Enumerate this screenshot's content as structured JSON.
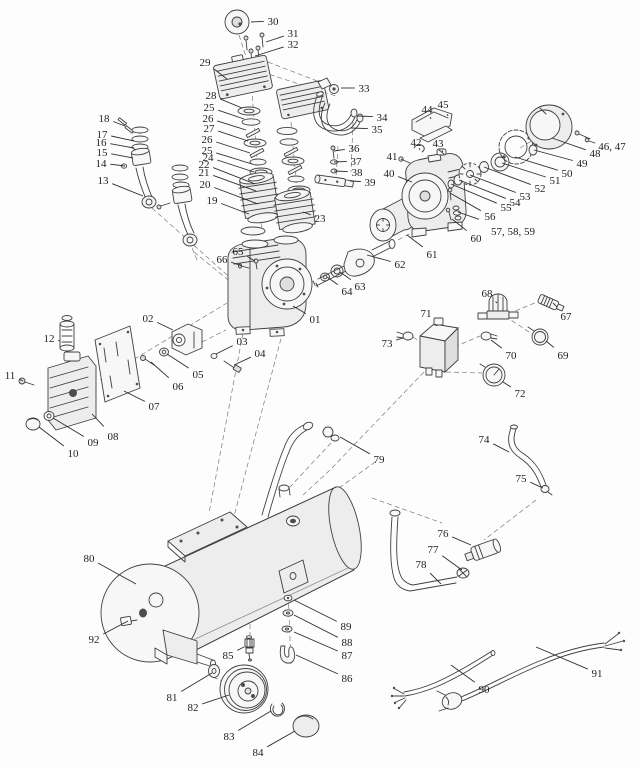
{
  "diagram": {
    "type": "exploded-parts-diagram",
    "subject": "air-compressor",
    "canvas": {
      "width": 640,
      "height": 768
    },
    "colors": {
      "background": "#fdfdfd",
      "line": "#3f3f3f",
      "label": "#1f1f1f",
      "dashed": "#7a7a7a"
    },
    "parts": [
      {
        "n": "30",
        "lx": 273,
        "ly": 21,
        "tx": 251,
        "ty": 22
      },
      {
        "n": "31",
        "lx": 293,
        "ly": 33,
        "tx": 266,
        "ty": 42
      },
      {
        "n": "32",
        "lx": 293,
        "ly": 44,
        "tx": 255,
        "ty": 56
      },
      {
        "n": "29",
        "lx": 205,
        "ly": 62,
        "tx": 227,
        "ty": 79
      },
      {
        "n": "33",
        "lx": 364,
        "ly": 88,
        "tx": 341,
        "ty": 88
      },
      {
        "n": "34",
        "lx": 382,
        "ly": 117,
        "tx": 357,
        "ty": 116
      },
      {
        "n": "35",
        "lx": 377,
        "ly": 129,
        "tx": 351,
        "ty": 128
      },
      {
        "n": "28",
        "lx": 211,
        "ly": 95,
        "tx": 242,
        "ty": 108
      },
      {
        "n": "25",
        "lx": 209,
        "ly": 107,
        "tx": 244,
        "ty": 119
      },
      {
        "n": "26",
        "lx": 208,
        "ly": 118,
        "tx": 246,
        "ty": 130
      },
      {
        "n": "27",
        "lx": 209,
        "ly": 128,
        "tx": 248,
        "ty": 141
      },
      {
        "n": "26",
        "lx": 207,
        "ly": 139,
        "tx": 250,
        "ty": 153
      },
      {
        "n": "25",
        "lx": 207,
        "ly": 150,
        "tx": 252,
        "ty": 164
      },
      {
        "n": "24",
        "lx": 208,
        "ly": 157,
        "tx": 254,
        "ty": 172
      },
      {
        "n": "22",
        "lx": 204,
        "ly": 164,
        "tx": 255,
        "ty": 184
      },
      {
        "n": "21",
        "lx": 204,
        "ly": 172,
        "tx": 256,
        "ty": 191
      },
      {
        "n": "20",
        "lx": 205,
        "ly": 184,
        "tx": 258,
        "ty": 204
      },
      {
        "n": "19",
        "lx": 212,
        "ly": 200,
        "tx": 249,
        "ty": 214
      },
      {
        "n": "18",
        "lx": 104,
        "ly": 118,
        "tx": 125,
        "ty": 126
      },
      {
        "n": "17",
        "lx": 102,
        "ly": 134,
        "tx": 134,
        "ty": 141
      },
      {
        "n": "16",
        "lx": 101,
        "ly": 142,
        "tx": 134,
        "ty": 148
      },
      {
        "n": "15",
        "lx": 102,
        "ly": 152,
        "tx": 133,
        "ty": 158
      },
      {
        "n": "14",
        "lx": 101,
        "ly": 163,
        "tx": 125,
        "ty": 166
      },
      {
        "n": "13",
        "lx": 103,
        "ly": 180,
        "tx": 143,
        "ty": 196
      },
      {
        "n": "23",
        "lx": 320,
        "ly": 218,
        "tx": 303,
        "ty": 212
      },
      {
        "n": "36",
        "lx": 354,
        "ly": 148,
        "tx": 334,
        "ty": 151
      },
      {
        "n": "37",
        "lx": 356,
        "ly": 161,
        "tx": 334,
        "ty": 162
      },
      {
        "n": "38",
        "lx": 357,
        "ly": 172,
        "tx": 334,
        "ty": 171
      },
      {
        "n": "39",
        "lx": 370,
        "ly": 182,
        "tx": 350,
        "ty": 181
      },
      {
        "n": "41",
        "lx": 392,
        "ly": 156,
        "tx": 403,
        "ty": 160
      },
      {
        "n": "40",
        "lx": 389,
        "ly": 173,
        "tx": 412,
        "ty": 182
      },
      {
        "n": "42",
        "lx": 416,
        "ly": 142,
        "tx": 420,
        "ty": 150
      },
      {
        "n": "43",
        "lx": 438,
        "ly": 143,
        "tx": 443,
        "ty": 152
      },
      {
        "n": "44",
        "lx": 427,
        "ly": 109,
        "tx": 431,
        "ty": 119
      },
      {
        "n": "45",
        "lx": 443,
        "ly": 104,
        "tx": 448,
        "ty": 116
      },
      {
        "n": "46, 47",
        "lx": 612,
        "ly": 146,
        "tx": 585,
        "ty": 137
      },
      {
        "n": "48",
        "lx": 595,
        "ly": 153,
        "tx": 552,
        "ty": 138
      },
      {
        "n": "49",
        "lx": 582,
        "ly": 163,
        "tx": 534,
        "ty": 150
      },
      {
        "n": "50",
        "lx": 567,
        "ly": 173,
        "tx": 515,
        "ty": 157
      },
      {
        "n": "51",
        "lx": 555,
        "ly": 180,
        "tx": 502,
        "ty": 163
      },
      {
        "n": "52",
        "lx": 540,
        "ly": 188,
        "tx": 484,
        "ty": 167
      },
      {
        "n": "53",
        "lx": 525,
        "ly": 196,
        "tx": 470,
        "ty": 175
      },
      {
        "n": "54",
        "lx": 515,
        "ly": 202,
        "tx": 459,
        "ty": 180
      },
      {
        "n": "55",
        "lx": 506,
        "ly": 207,
        "tx": 451,
        "ty": 184
      },
      {
        "n": "56",
        "lx": 490,
        "ly": 216,
        "tx": 450,
        "ty": 193
      },
      {
        "n": "57, 58, 59",
        "lx": 513,
        "ly": 231,
        "tx": 458,
        "ty": 212
      },
      {
        "n": "60",
        "lx": 476,
        "ly": 238,
        "tx": 452,
        "ty": 219
      },
      {
        "n": "61",
        "lx": 432,
        "ly": 254,
        "tx": 407,
        "ty": 235
      },
      {
        "n": "62",
        "lx": 400,
        "ly": 264,
        "tx": 367,
        "ty": 255
      },
      {
        "n": "63",
        "lx": 360,
        "ly": 286,
        "tx": 340,
        "ty": 272
      },
      {
        "n": "64",
        "lx": 347,
        "ly": 291,
        "tx": 327,
        "ty": 277
      },
      {
        "n": "65",
        "lx": 238,
        "ly": 251,
        "tx": 255,
        "ty": 261
      },
      {
        "n": "66",
        "lx": 222,
        "ly": 259,
        "tx": 242,
        "ty": 266
      },
      {
        "n": "01",
        "lx": 315,
        "ly": 319,
        "tx": 293,
        "ty": 306
      },
      {
        "n": "02",
        "lx": 148,
        "ly": 318,
        "tx": 173,
        "ty": 330
      },
      {
        "n": "03",
        "lx": 242,
        "ly": 341,
        "tx": 216,
        "ty": 354
      },
      {
        "n": "04",
        "lx": 260,
        "ly": 353,
        "tx": 234,
        "ty": 365
      },
      {
        "n": "05",
        "lx": 198,
        "ly": 374,
        "tx": 167,
        "ty": 354
      },
      {
        "n": "06",
        "lx": 178,
        "ly": 386,
        "tx": 151,
        "ty": 362
      },
      {
        "n": "07",
        "lx": 154,
        "ly": 406,
        "tx": 124,
        "ty": 391
      },
      {
        "n": "08",
        "lx": 113,
        "ly": 436,
        "tx": 92,
        "ty": 414
      },
      {
        "n": "09",
        "lx": 93,
        "ly": 442,
        "tx": 53,
        "ty": 418
      },
      {
        "n": "10",
        "lx": 73,
        "ly": 453,
        "tx": 39,
        "ty": 427
      },
      {
        "n": "11",
        "lx": 10,
        "ly": 375,
        "tx": 23,
        "ty": 381
      },
      {
        "n": "12",
        "lx": 49,
        "ly": 338,
        "tx": 60,
        "ty": 341
      },
      {
        "n": "67",
        "lx": 566,
        "ly": 316,
        "tx": 553,
        "ty": 303
      },
      {
        "n": "68",
        "lx": 487,
        "ly": 293,
        "tx": 497,
        "ty": 303
      },
      {
        "n": "69",
        "lx": 563,
        "ly": 355,
        "tx": 546,
        "ty": 341
      },
      {
        "n": "70",
        "lx": 511,
        "ly": 355,
        "tx": 491,
        "ty": 340
      },
      {
        "n": "71",
        "lx": 426,
        "ly": 313,
        "tx": 437,
        "ty": 326
      },
      {
        "n": "72",
        "lx": 520,
        "ly": 393,
        "tx": 503,
        "ty": 382
      },
      {
        "n": "73",
        "lx": 387,
        "ly": 343,
        "tx": 403,
        "ty": 338
      },
      {
        "n": "74",
        "lx": 484,
        "ly": 439,
        "tx": 509,
        "ty": 452
      },
      {
        "n": "75",
        "lx": 521,
        "ly": 478,
        "tx": 543,
        "ty": 488
      },
      {
        "n": "76",
        "lx": 443,
        "ly": 533,
        "tx": 471,
        "ty": 545
      },
      {
        "n": "77",
        "lx": 433,
        "ly": 549,
        "tx": 462,
        "ty": 570
      },
      {
        "n": "78",
        "lx": 421,
        "ly": 564,
        "tx": 441,
        "ty": 584
      },
      {
        "n": "79",
        "lx": 379,
        "ly": 459,
        "tx": 340,
        "ty": 437
      },
      {
        "n": "80",
        "lx": 89,
        "ly": 558,
        "tx": 136,
        "ty": 584
      },
      {
        "n": "81",
        "lx": 172,
        "ly": 697,
        "tx": 212,
        "ty": 673
      },
      {
        "n": "82",
        "lx": 193,
        "ly": 707,
        "tx": 229,
        "ty": 695
      },
      {
        "n": "83",
        "lx": 229,
        "ly": 736,
        "tx": 271,
        "ty": 711
      },
      {
        "n": "84",
        "lx": 258,
        "ly": 752,
        "tx": 295,
        "ty": 731
      },
      {
        "n": "85",
        "lx": 228,
        "ly": 655,
        "tx": 244,
        "ty": 647
      },
      {
        "n": "86",
        "lx": 347,
        "ly": 678,
        "tx": 296,
        "ty": 655
      },
      {
        "n": "87",
        "lx": 347,
        "ly": 655,
        "tx": 294,
        "ty": 632
      },
      {
        "n": "88",
        "lx": 347,
        "ly": 642,
        "tx": 294,
        "ty": 615
      },
      {
        "n": "89",
        "lx": 346,
        "ly": 626,
        "tx": 294,
        "ty": 600
      },
      {
        "n": "90",
        "lx": 484,
        "ly": 689,
        "tx": 451,
        "ty": 665
      },
      {
        "n": "91",
        "lx": 597,
        "ly": 673,
        "tx": 536,
        "ty": 647
      },
      {
        "n": "92",
        "lx": 94,
        "ly": 639,
        "tx": 128,
        "ty": 621
      }
    ]
  }
}
